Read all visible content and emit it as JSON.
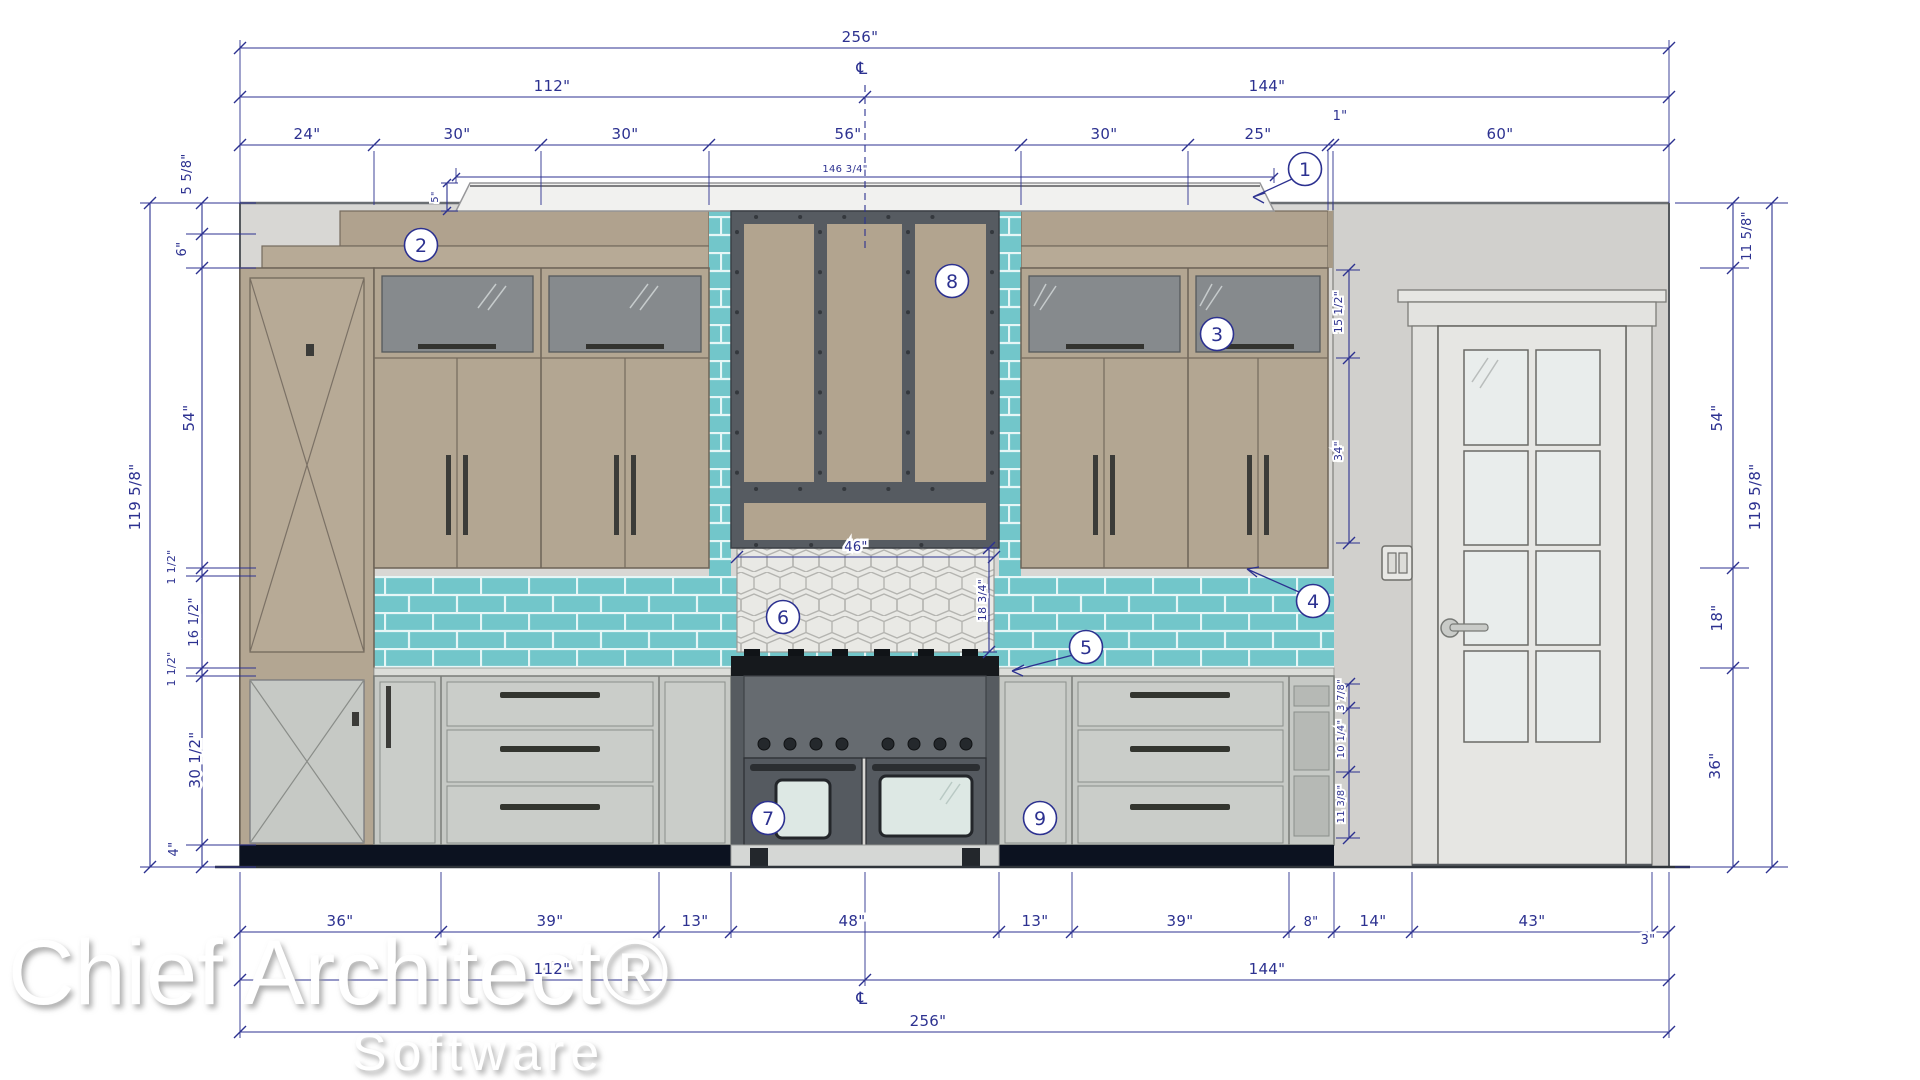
{
  "app": {
    "watermark_line1": "Chief Architect®",
    "watermark_line2": "Software"
  },
  "symbols": {
    "centerline": "℄"
  },
  "dims": {
    "top": {
      "overall": "256\"",
      "left_half": "112\"",
      "right_half": "144\"",
      "segments": [
        "24\"",
        "30\"",
        "30\"",
        "56\"",
        "30\"",
        "25\"",
        "1\"",
        "60\""
      ],
      "cap_width": "146 3/4\"",
      "cap_height": "5\""
    },
    "left": {
      "overall": "119 5/8\"",
      "segments": [
        "5 5/8\"",
        "6\"",
        "54\"",
        "1 1/2\"",
        "16 1/2\"",
        "1 1/2\"",
        "30 1/2\"",
        "4\""
      ]
    },
    "right": {
      "overall": "119 5/8\"",
      "segments": [
        "11 5/8\"",
        "54\"",
        "18\"",
        "36\""
      ],
      "cabinet_segments": [
        "15 1/2\"",
        "34\""
      ],
      "shelf_segments": [
        "3 7/8\"",
        "10 1/4\"",
        "11 3/8\""
      ]
    },
    "bottom": {
      "overall": "256\"",
      "left_half": "112\"",
      "right_half": "144\"",
      "segments": [
        "36\"",
        "39\"",
        "13\"",
        "48\"",
        "13\"",
        "39\"",
        "8\"",
        "14\"",
        "43\"",
        "3\""
      ]
    },
    "backsplash": {
      "width": "46\"",
      "height": "18 3/4\""
    }
  },
  "callouts": {
    "c1": "1",
    "c2": "2",
    "c3": "3",
    "c4": "4",
    "c5": "5",
    "c6": "6",
    "c7": "7",
    "c8": "8",
    "c9": "9"
  },
  "colors": {
    "dimension": "#2c3190",
    "tile_teal": "#72c6ca",
    "cabinet_taupe": "#b3a692",
    "base_gray": "#c6c9c5",
    "hood_strap": "#565b61",
    "toe_kick": "#0c1220"
  }
}
